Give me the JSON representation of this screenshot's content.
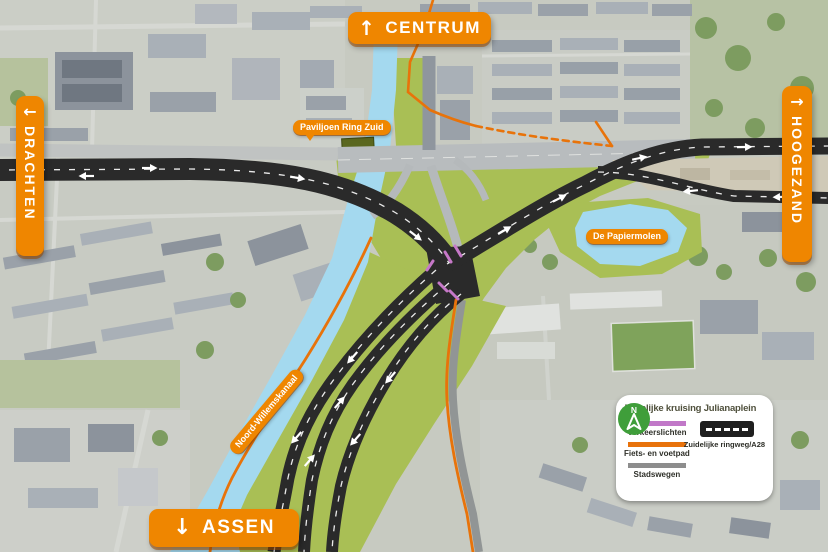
{
  "signs": {
    "centrum": {
      "arrow": "↑",
      "label": "CENTRUM"
    },
    "drachten": {
      "arrow": "←",
      "label": "DRACHTEN"
    },
    "hoogezand": {
      "arrow": "→",
      "label": "HOOGEZAND"
    },
    "assen": {
      "arrow": "↓",
      "label": "ASSEN"
    }
  },
  "map_labels": {
    "paviljoen": "Paviljoen Ring Zuid",
    "papiermolen": "De Papiermolen",
    "kanaal": "Noord-Willemskanaal"
  },
  "legend": {
    "title": "Tijdelijke kruising Julianaplein",
    "items": [
      {
        "label": "Verkeerslichten",
        "color": "#c178c8"
      },
      {
        "label": "Fiets- en voetpad",
        "color": "#e8720b"
      },
      {
        "label": "Stadswegen",
        "color": "#8d8d8d"
      },
      {
        "label": "Zuidelijke ringweg/A28",
        "color": "#1f1f1f"
      }
    ],
    "compass_label": "N"
  },
  "colors": {
    "sign_orange": "#ef8600",
    "highway_black": "#2a2a2a",
    "bike_path_orange": "#e8730a",
    "traffic_light_purple": "#c678c8",
    "city_road_gray": "#919595",
    "water_blue": "#a4d9ef",
    "grass_green": "#a9bf55"
  }
}
